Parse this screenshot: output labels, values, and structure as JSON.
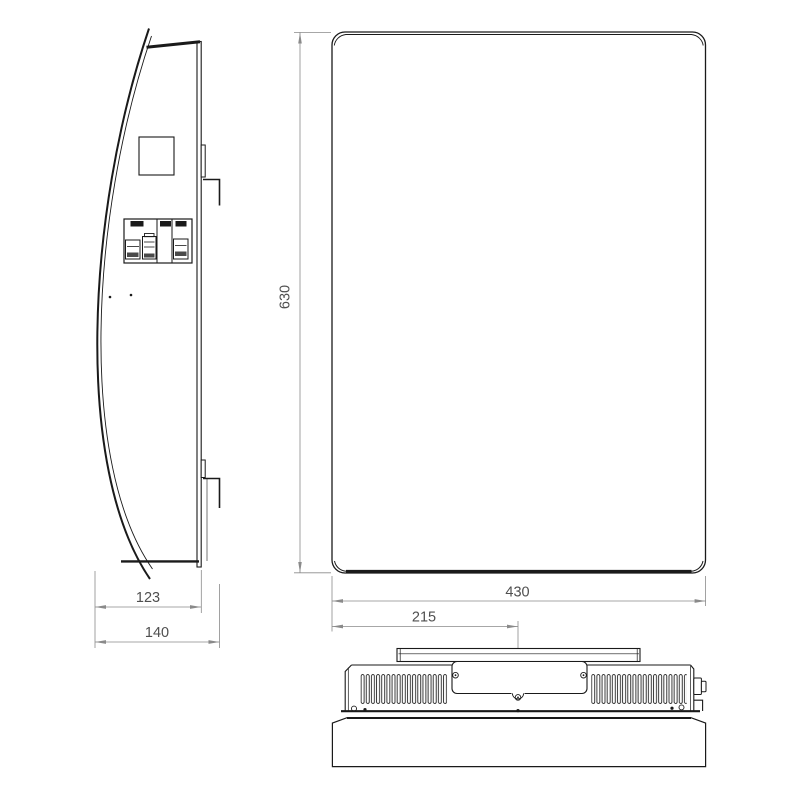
{
  "colors": {
    "background": "#ffffff",
    "outline": "#1a1a1a",
    "dimension": "#8a8a8a",
    "dimension_text": "#4f4f4f"
  },
  "dimensions": {
    "front_height": "630",
    "front_width": "430",
    "bottom_center_offset": "215",
    "side_depth_body": "123",
    "side_depth_total": "140"
  }
}
